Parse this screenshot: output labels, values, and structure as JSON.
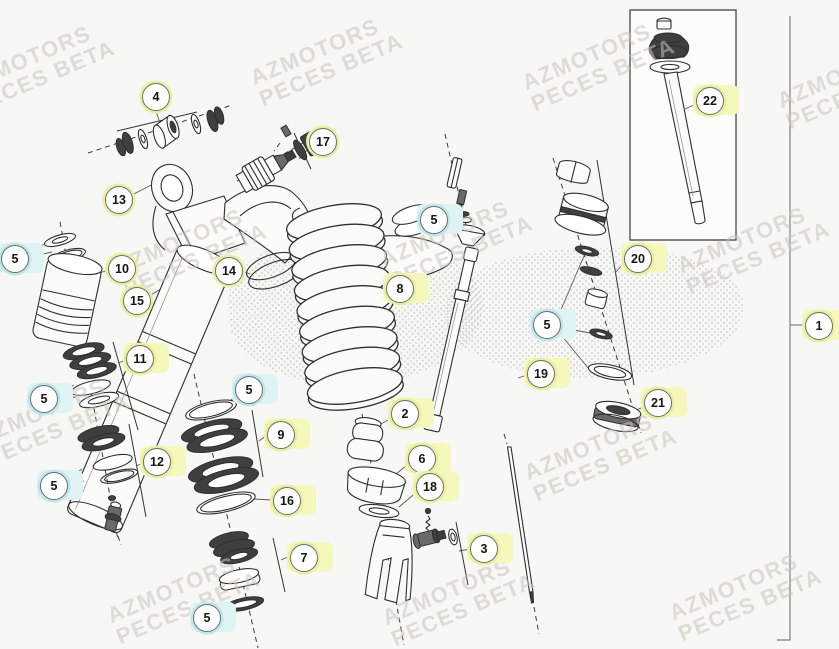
{
  "colors": {
    "background": "#f7f7f5",
    "line": "#2e2e2e",
    "callout-yellow": "#f5f7bb",
    "callout-ring-yellow": "#e9efa0",
    "callout-cyan": "#dff3f5",
    "callout-ring-cyan": "#bfe7ea",
    "watermark": "#c9c5ba"
  },
  "watermark": {
    "line1": "AZMOTORS",
    "line2": "PECES BETA",
    "instances": [
      {
        "x": -38,
        "y": 44
      },
      {
        "x": 250,
        "y": 37
      },
      {
        "x": 522,
        "y": 42
      },
      {
        "x": 777,
        "y": 60
      },
      {
        "x": 114,
        "y": 227
      },
      {
        "x": 380,
        "y": 219
      },
      {
        "x": 677,
        "y": 225
      },
      {
        "x": -23,
        "y": 397
      },
      {
        "x": 524,
        "y": 432
      },
      {
        "x": 107,
        "y": 575
      },
      {
        "x": 382,
        "y": 577
      },
      {
        "x": 669,
        "y": 572
      }
    ]
  },
  "callouts": [
    {
      "label": "4",
      "x": 155,
      "y": 96,
      "style": "ring y"
    },
    {
      "label": "17",
      "x": 322,
      "y": 141,
      "style": "ring y"
    },
    {
      "label": "13",
      "x": 118,
      "y": 199,
      "style": "ring y"
    },
    {
      "label": "5",
      "x": 14,
      "y": 258,
      "style": "tag-cyan"
    },
    {
      "label": "10",
      "x": 121,
      "y": 268,
      "style": "ring y"
    },
    {
      "label": "14",
      "x": 228,
      "y": 270,
      "style": "ring y"
    },
    {
      "label": "15",
      "x": 136,
      "y": 300,
      "style": "ring y"
    },
    {
      "label": "5",
      "x": 433,
      "y": 219,
      "style": "tag-cyan"
    },
    {
      "label": "8",
      "x": 399,
      "y": 288,
      "style": "tag-yellow"
    },
    {
      "label": "11",
      "x": 139,
      "y": 358,
      "style": "tag-yellow"
    },
    {
      "label": "19",
      "x": 540,
      "y": 373,
      "style": "tag-yellow"
    },
    {
      "label": "20",
      "x": 637,
      "y": 258,
      "style": "tag-yellow"
    },
    {
      "label": "5",
      "x": 546,
      "y": 324,
      "style": "tag-cyan"
    },
    {
      "label": "21",
      "x": 657,
      "y": 402,
      "style": "tag-yellow"
    },
    {
      "label": "5",
      "x": 43,
      "y": 398,
      "style": "tag-cyan"
    },
    {
      "label": "5",
      "x": 248,
      "y": 389,
      "style": "tag-cyan"
    },
    {
      "label": "9",
      "x": 280,
      "y": 434,
      "style": "tag-yellow"
    },
    {
      "label": "2",
      "x": 404,
      "y": 413,
      "style": "tag-yellow"
    },
    {
      "label": "12",
      "x": 156,
      "y": 461,
      "style": "tag-yellow"
    },
    {
      "label": "6",
      "x": 421,
      "y": 458,
      "style": "tag-yellow"
    },
    {
      "label": "5",
      "x": 53,
      "y": 485,
      "style": "tag-cyan"
    },
    {
      "label": "18",
      "x": 429,
      "y": 486,
      "style": "tag-yellow"
    },
    {
      "label": "16",
      "x": 286,
      "y": 500,
      "style": "tag-yellow"
    },
    {
      "label": "7",
      "x": 303,
      "y": 557,
      "style": "tag-yellow"
    },
    {
      "label": "3",
      "x": 483,
      "y": 548,
      "style": "tag-yellow"
    },
    {
      "label": "5",
      "x": 206,
      "y": 617,
      "style": "tag-cyan"
    },
    {
      "label": "22",
      "x": 709,
      "y": 100,
      "style": "tag-yellow"
    },
    {
      "label": "1",
      "x": 818,
      "y": 325,
      "style": "tag-yellow"
    }
  ]
}
